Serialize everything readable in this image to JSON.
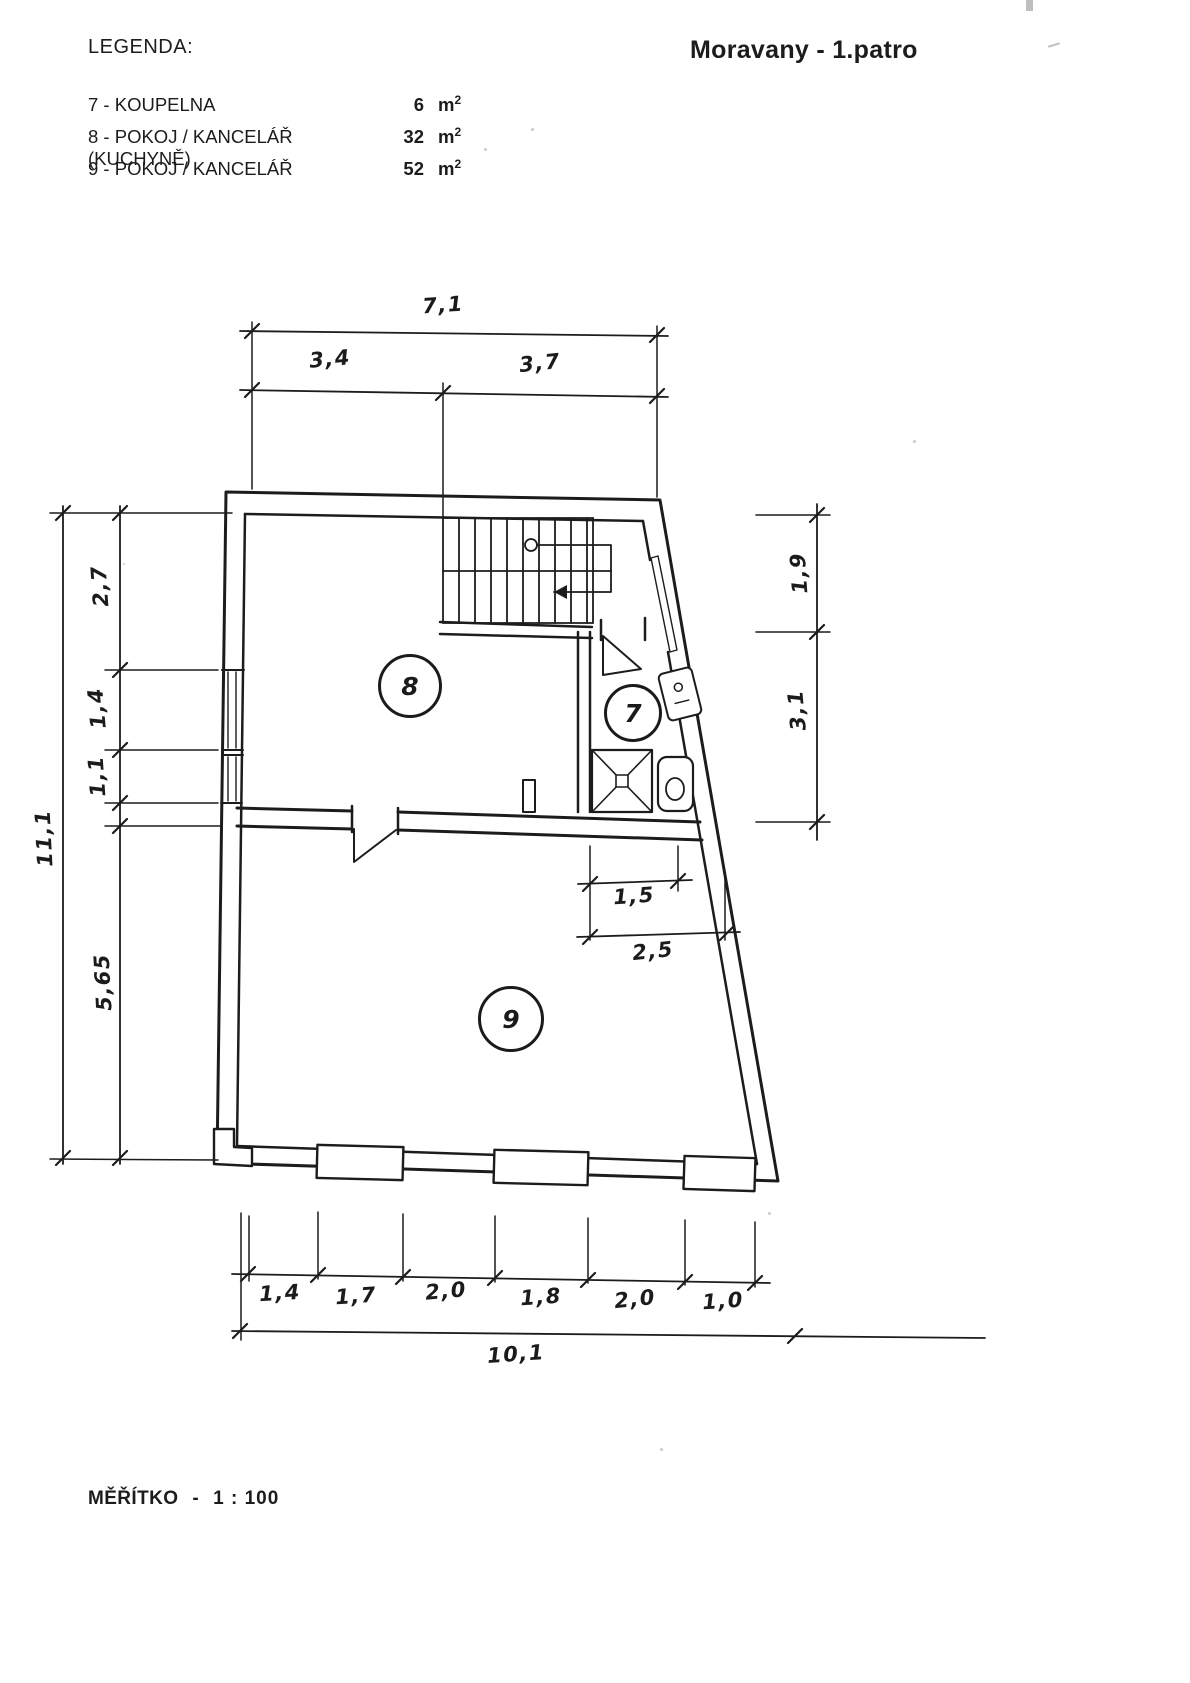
{
  "header": {
    "legend_heading": "LEGENDA:",
    "title": "Moravany - 1.patro"
  },
  "legend": {
    "items": [
      {
        "label": "7 - KOUPELNA",
        "area": "6",
        "unit_base": "m",
        "unit_exp": "2"
      },
      {
        "label": "8 - POKOJ / KANCELÁŘ (KUCHYNĚ)",
        "area": "32",
        "unit_base": "m",
        "unit_exp": "2"
      },
      {
        "label": "9 - POKOJ / KANCELÁŘ",
        "area": "52",
        "unit_base": "m",
        "unit_exp": "2"
      }
    ]
  },
  "floor_plan": {
    "rooms": [
      {
        "id": "8"
      },
      {
        "id": "7"
      },
      {
        "id": "9"
      }
    ],
    "dims": {
      "top_total": "7,1",
      "top_segments": [
        "3,4",
        "3,7"
      ],
      "left_total": "11,1",
      "left_segments": [
        "2,7",
        "1,4",
        "1,1",
        "5,65"
      ],
      "right_segments": [
        "1,9",
        "3,1"
      ],
      "inner_segments": [
        "1,5",
        "2,5"
      ],
      "bottom_segments": [
        "1,4",
        "1,7",
        "2,0",
        "1,8",
        "2,0",
        "1,0"
      ],
      "bottom_total": "10,1"
    }
  },
  "footer": {
    "scale_label": "MĚŘÍTKO",
    "scale_sep": "-",
    "scale_value": "1 : 100"
  }
}
